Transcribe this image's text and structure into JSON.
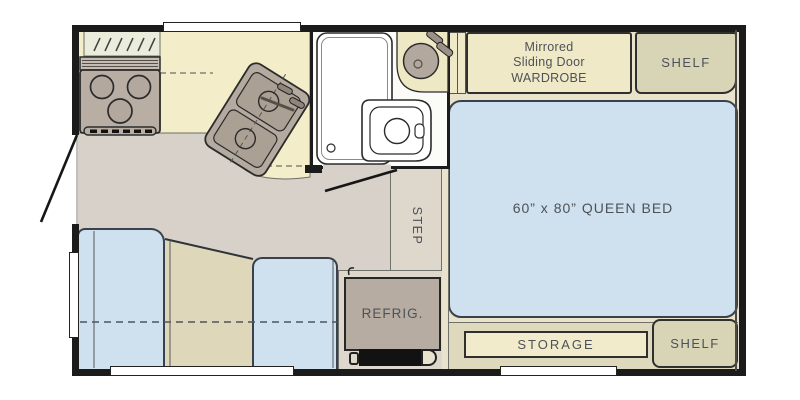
{
  "labels": {
    "wardrobe_line1": "Mirrored",
    "wardrobe_line2": "Sliding Door",
    "wardrobe_line3": "WARDROBE",
    "shelf_top": "SHELF",
    "queen_bed": "60” x 80” QUEEN BED",
    "step": "STEP",
    "refrigerator": "REFRIG.",
    "storage": "STORAGE",
    "shelf_bottom": "SHELF"
  },
  "colors": {
    "wall": "#1b1b1b",
    "floor": "#d8d1c9",
    "counter": "#f3edca",
    "cream": "#f0e9c7",
    "storagecream": "#f1eacb",
    "sage": "#d8d4b6",
    "band": "#ded8bd",
    "blue": "#cfe0ee",
    "tan": "#ded7cb",
    "seattan": "#ded7ba",
    "appliance": "#b7aca2",
    "hatch": "#ebeddc",
    "bathroom": "#fbfbf8",
    "margin": "#e9e3cb",
    "label": "#4d5258"
  }
}
